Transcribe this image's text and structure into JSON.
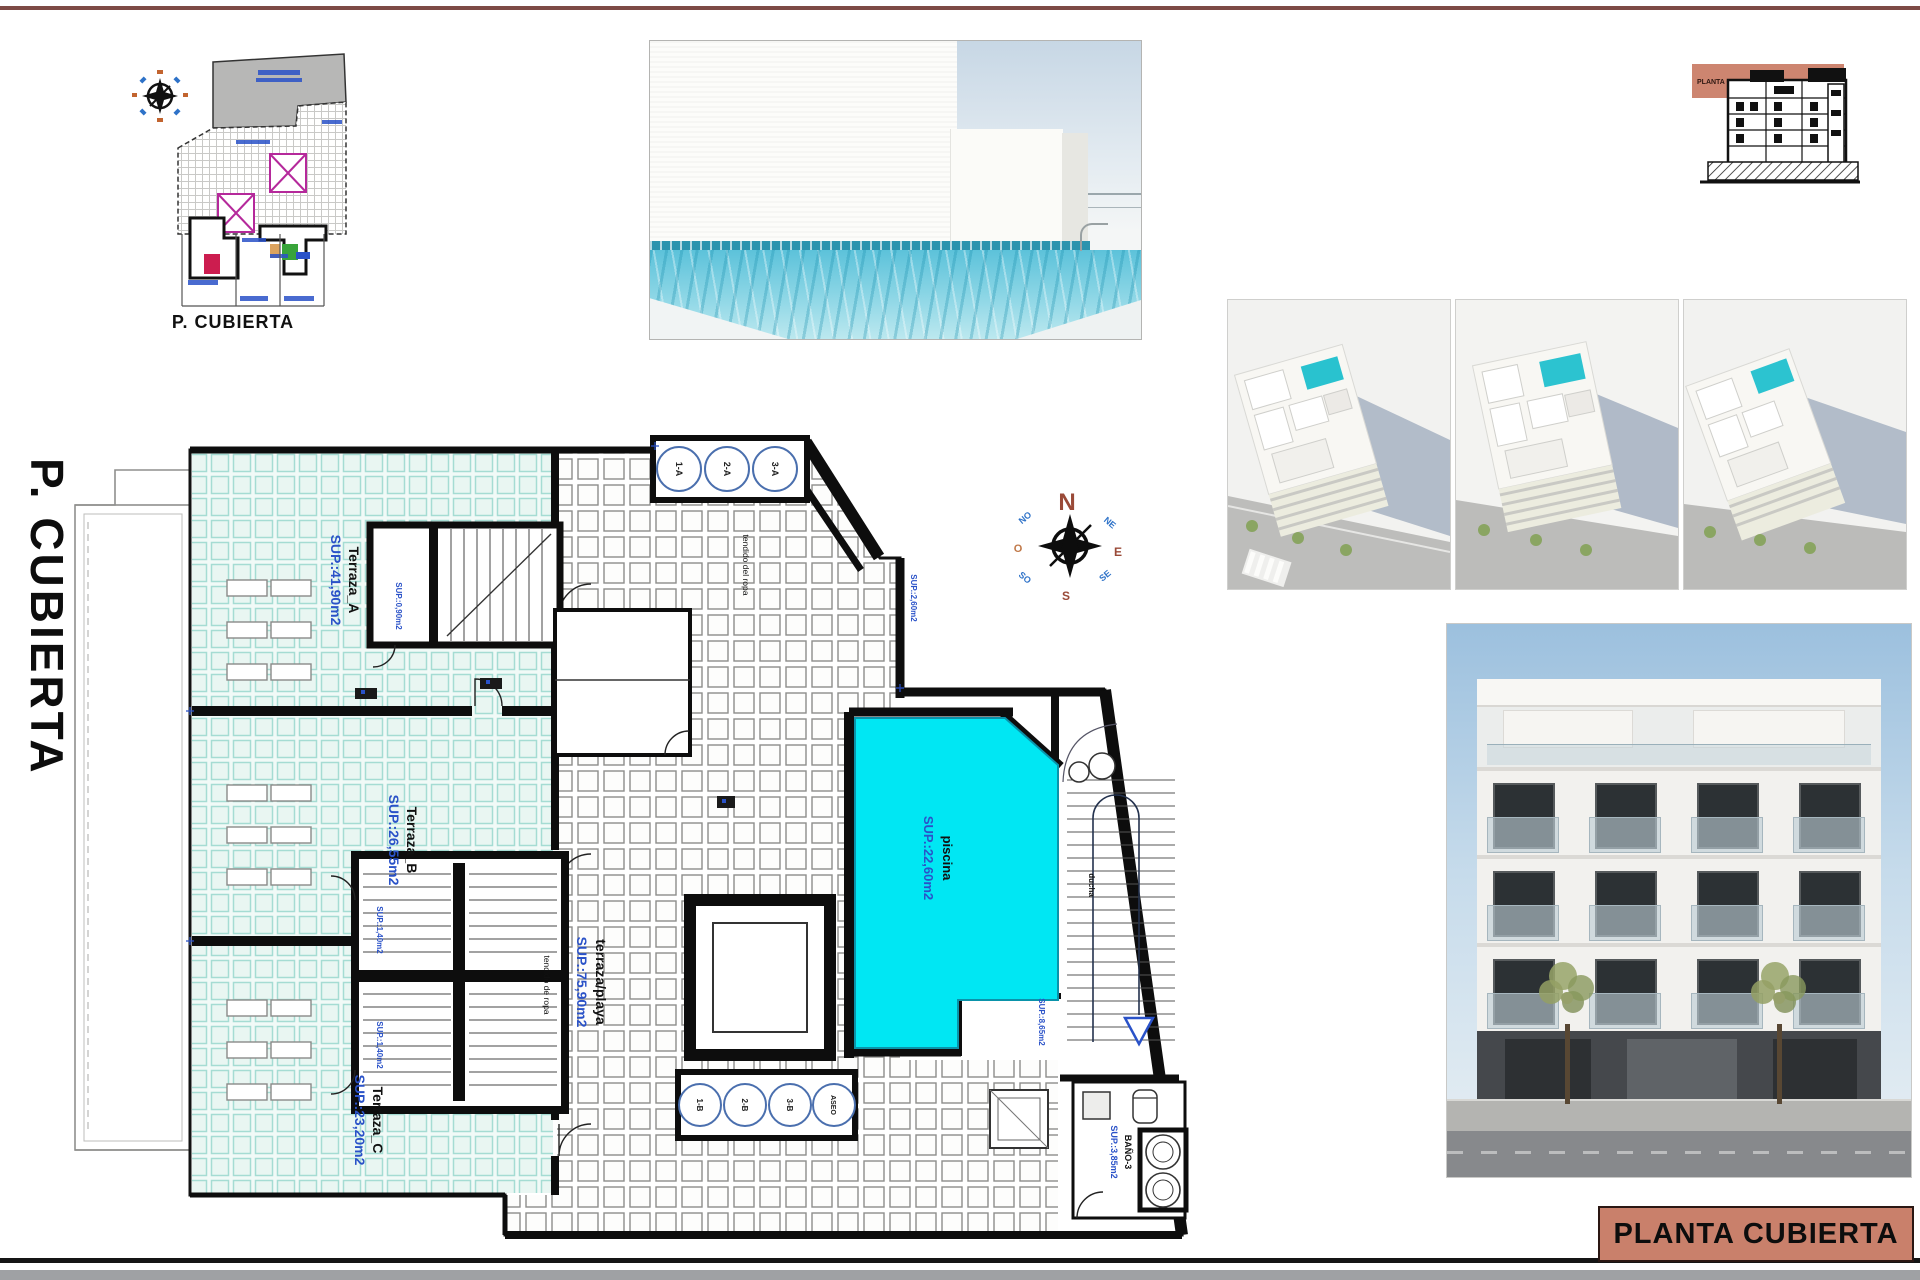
{
  "sheet": {
    "margin_title": "P. CUBIERTA",
    "top_rule_color": "#7d4a45",
    "bottom_bar_color": "#9fa1a4"
  },
  "title_block": {
    "label": "PLANTA CUBIERTA",
    "bg_color": "#c9806b"
  },
  "site_plan": {
    "caption": "P. CUBIERTA"
  },
  "section_drawing": {
    "band_label": "PLANTA CUBIERTA",
    "band_color": "#cd8570"
  },
  "compass": {
    "north": "N",
    "south": "S",
    "east": "E",
    "west": "O",
    "ne": "NE",
    "nw": "NO",
    "se": "SE",
    "sw": "SO"
  },
  "plan": {
    "terraces": [
      {
        "name": "Terraza_A",
        "area": "SUP.:41,90m2"
      },
      {
        "name": "Terraza_B",
        "area": "SUP.:26,55m2"
      },
      {
        "name": "Terraza_C",
        "area": "SUP.:23,20m2"
      }
    ],
    "beach_terrace": {
      "name": "terraza/playa",
      "area": "SUP.:75,90m2"
    },
    "pool": {
      "name": "piscina",
      "area": "SUP.:22,60m2",
      "color": "#00e7f3"
    },
    "bathroom": {
      "name": "BAÑO-3",
      "area": "SUP.:3,85m2"
    },
    "shower_label": "ducha",
    "clothesline_top": "tendido del ropa",
    "clothesline_left": "tendido de ropa",
    "small_areas": {
      "stair_top": "SUP.:0,90m2",
      "stair_mid_upper": "SUP.:1,40m2",
      "stair_mid_lower": "SUP.:1,40m2",
      "walkway": "SUP.:2,60m2",
      "stair_right": "SUP.:8,65m2"
    },
    "skylights_a": [
      "1-A",
      "2-A",
      "3-A"
    ],
    "skylights_b": [
      "1-B",
      "2-B",
      "3-B",
      "ASEO"
    ]
  }
}
